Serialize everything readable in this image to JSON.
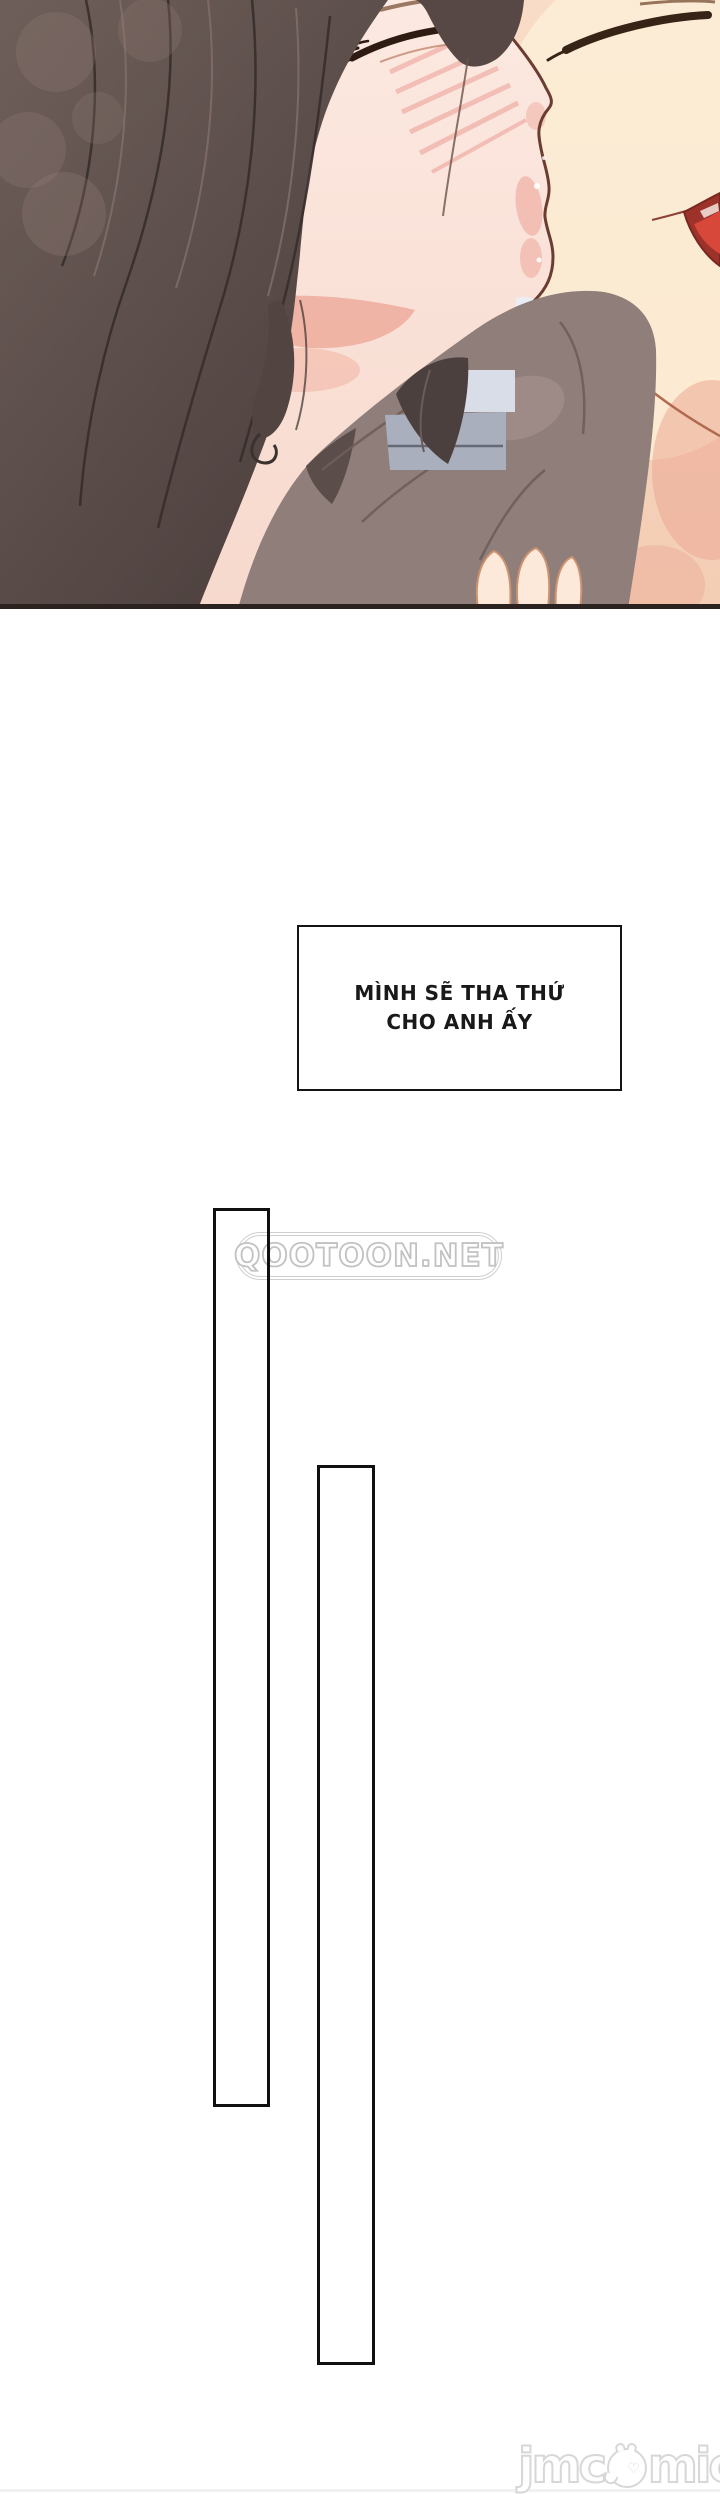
{
  "page": {
    "width": 720,
    "height": 2492,
    "background": "#ffffff"
  },
  "panel_illustration": {
    "description": "close-up of two manhwa characters kissing, woman with long dark hair on the left, man's face on the right",
    "border_bottom_color": "#2a231f",
    "palette": {
      "background_pink": "#f4d4c8",
      "woman_skin": "#fbe7df",
      "man_skin": "#f8dac5",
      "hair_dark": "#4a3e3c",
      "hair_light": "#6f5f5a",
      "blush": "#ec9d94",
      "tongue_red": "#d8483a",
      "fabric_gray": "#8f7e7a",
      "strap_dark": "#4b403d",
      "gap_bluegray": "#a9afbc"
    }
  },
  "speech_box": {
    "lines": [
      "MÌNH SẼ THA THỨ",
      "CHO ANH ẤY"
    ],
    "text_color": "#191919",
    "border_color": "#151515"
  },
  "watermarks": {
    "qootoon": {
      "text": "QOOTOON.NET",
      "color": "#c2c2c2"
    },
    "jmcomic": {
      "text_left": "jmc",
      "text_right": "mic",
      "icon": "chick-face-icon",
      "color": "#d7d7d7"
    }
  }
}
